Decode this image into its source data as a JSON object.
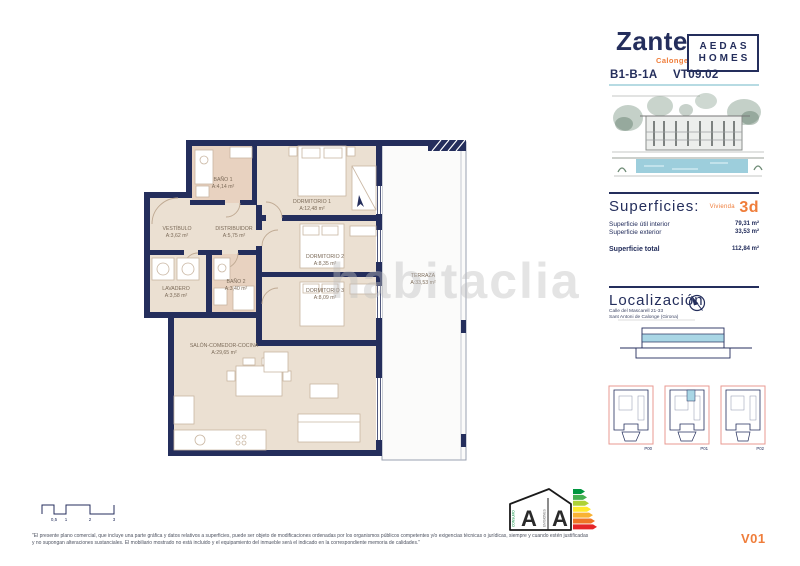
{
  "header": {
    "project_name": "Zante",
    "project_subtitle": "Calonge",
    "brand_top": "AEDAS",
    "brand_bottom": "HOMES",
    "unit_code": "B1-B-1A",
    "view_code": "VT09.02"
  },
  "superficies": {
    "title": "Superficies:",
    "unit_type_label": "Vivienda",
    "unit_type_value": "3d",
    "rows": [
      {
        "label": "Superficie útil interior",
        "value": "79,31 m²"
      },
      {
        "label": "Superficie exterior",
        "value": "33,53 m²"
      }
    ],
    "total": {
      "label": "Superficie total",
      "value": "112,84 m²"
    }
  },
  "localizacion": {
    "title": "Localización",
    "address_line1": "Calle del Mascarell 21-33",
    "address_line2": "Sant Antoni de Calonge (Girona)"
  },
  "keyplans": {
    "labels": [
      "P00",
      "P01",
      "P02"
    ]
  },
  "floorplan": {
    "rooms": [
      {
        "name": "BAÑO 1",
        "area": "A:4,14 m²"
      },
      {
        "name": "DORMITORIO 1",
        "area": "A:12,48 m²"
      },
      {
        "name": "VESTÍBULO",
        "area": "A:3,62 m²"
      },
      {
        "name": "DISTRIBUIDOR",
        "area": "A:5,75 m²"
      },
      {
        "name": "LAVADERO",
        "area": "A:3,58 m²"
      },
      {
        "name": "BAÑO 2",
        "area": "A:3,40 m²"
      },
      {
        "name": "DORMITORIO 2",
        "area": "A:8,35 m²"
      },
      {
        "name": "DORMITORIO 3",
        "area": "A:8,09 m²"
      },
      {
        "name": "SALÓN-COMEDOR-COCINA",
        "area": "A:29,65 m²"
      },
      {
        "name": "TERRAZA",
        "area": "A:33,53 m²"
      }
    ]
  },
  "scale_bar": {
    "labels": [
      "0,5",
      "1",
      "2",
      "3"
    ]
  },
  "energy_label": {
    "left_letter": "A",
    "right_letter": "A",
    "left_caption": "CONSUMO",
    "right_caption": "EMISIONES"
  },
  "watermark": "habitaclia",
  "footer": {
    "disclaimer_line1": "\"El presente plano comercial, que incluye una parte gráfica y datos relativos a superficies, puede ser objeto de modificaciones ordenadas por los organismos públicos competentes y/o exigencias técnicas o jurídicas, siempre y cuando estén justificadas",
    "disclaimer_line2": "y no supongan alteraciones sustanciales. El mobiliario mostrado no está incluido y el equipamiento del inmueble será el indicado en la correspondiente memoria de calidades.\"",
    "version": "V01"
  },
  "colors": {
    "navy": "#242e5c",
    "orange": "#ef7d3a",
    "beige": "#ebe0d2",
    "tan": "#e8d2c0",
    "light_blue": "#a9d6e5",
    "keyplan_pink": "#e89a92"
  }
}
